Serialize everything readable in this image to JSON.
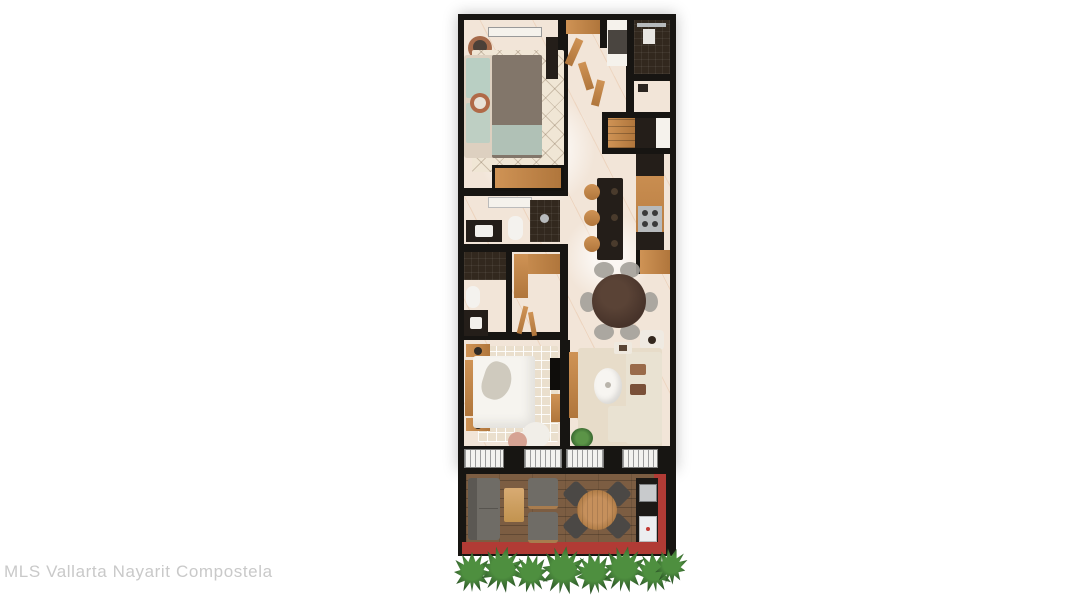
{
  "watermark": {
    "text": "MLS Vallarta Nayarit Compostela"
  },
  "plan": {
    "type": "3d-rendered-floor-plan",
    "description": "Top-down 3D rendering of a narrow two-bedroom apartment with rear terrace",
    "rooms": [
      "master-bedroom",
      "entry-hall",
      "shower-bathroom",
      "powder-room",
      "linen-closet",
      "kitchen",
      "ensuite-bathroom",
      "guest-bathroom",
      "walk-in-closet",
      "dining-area",
      "second-bedroom",
      "living-room",
      "terrace"
    ],
    "furniture": [
      "master-bed",
      "bedroom-bench",
      "kitchen-island",
      "bar-stools",
      "stove",
      "refrigerator",
      "round-dining-table",
      "dining-chairs",
      "accent-chair",
      "guest-bed",
      "lounge-chair",
      "tv",
      "tv-console",
      "coffee-table",
      "sectional-sofa",
      "outdoor-sofa",
      "outdoor-armchairs",
      "outdoor-dining-table",
      "grill-station",
      "cooler",
      "toilets",
      "vanities",
      "showers",
      "planter-plants"
    ]
  },
  "palette": {
    "bg": "#ffffff",
    "watermark": "#c9c9c9",
    "wall": "#171512",
    "floor": "#f2e5d8",
    "wood": "#cf9355",
    "wood-dark": "#b0763c",
    "dark-counter": "#241e19",
    "tile-dark": "#32281e",
    "sage": "#b9cfc3",
    "duvet": "#82766a",
    "white-soft": "#f5f2ec",
    "cream": "#e9e2d2",
    "rug": "#f0e6d5",
    "rug2": "#eadfcd",
    "rug3": "#e7dcc9",
    "table-brown": "#47332a",
    "chair-gray": "#a5a29b",
    "deck": "#7c5d42",
    "planter-red": "#b13b35",
    "plant-green": "#4e8f3f",
    "plant-dark": "#2a5226",
    "steel": "#b7babc",
    "terrace-gray": "#6f6c66"
  }
}
